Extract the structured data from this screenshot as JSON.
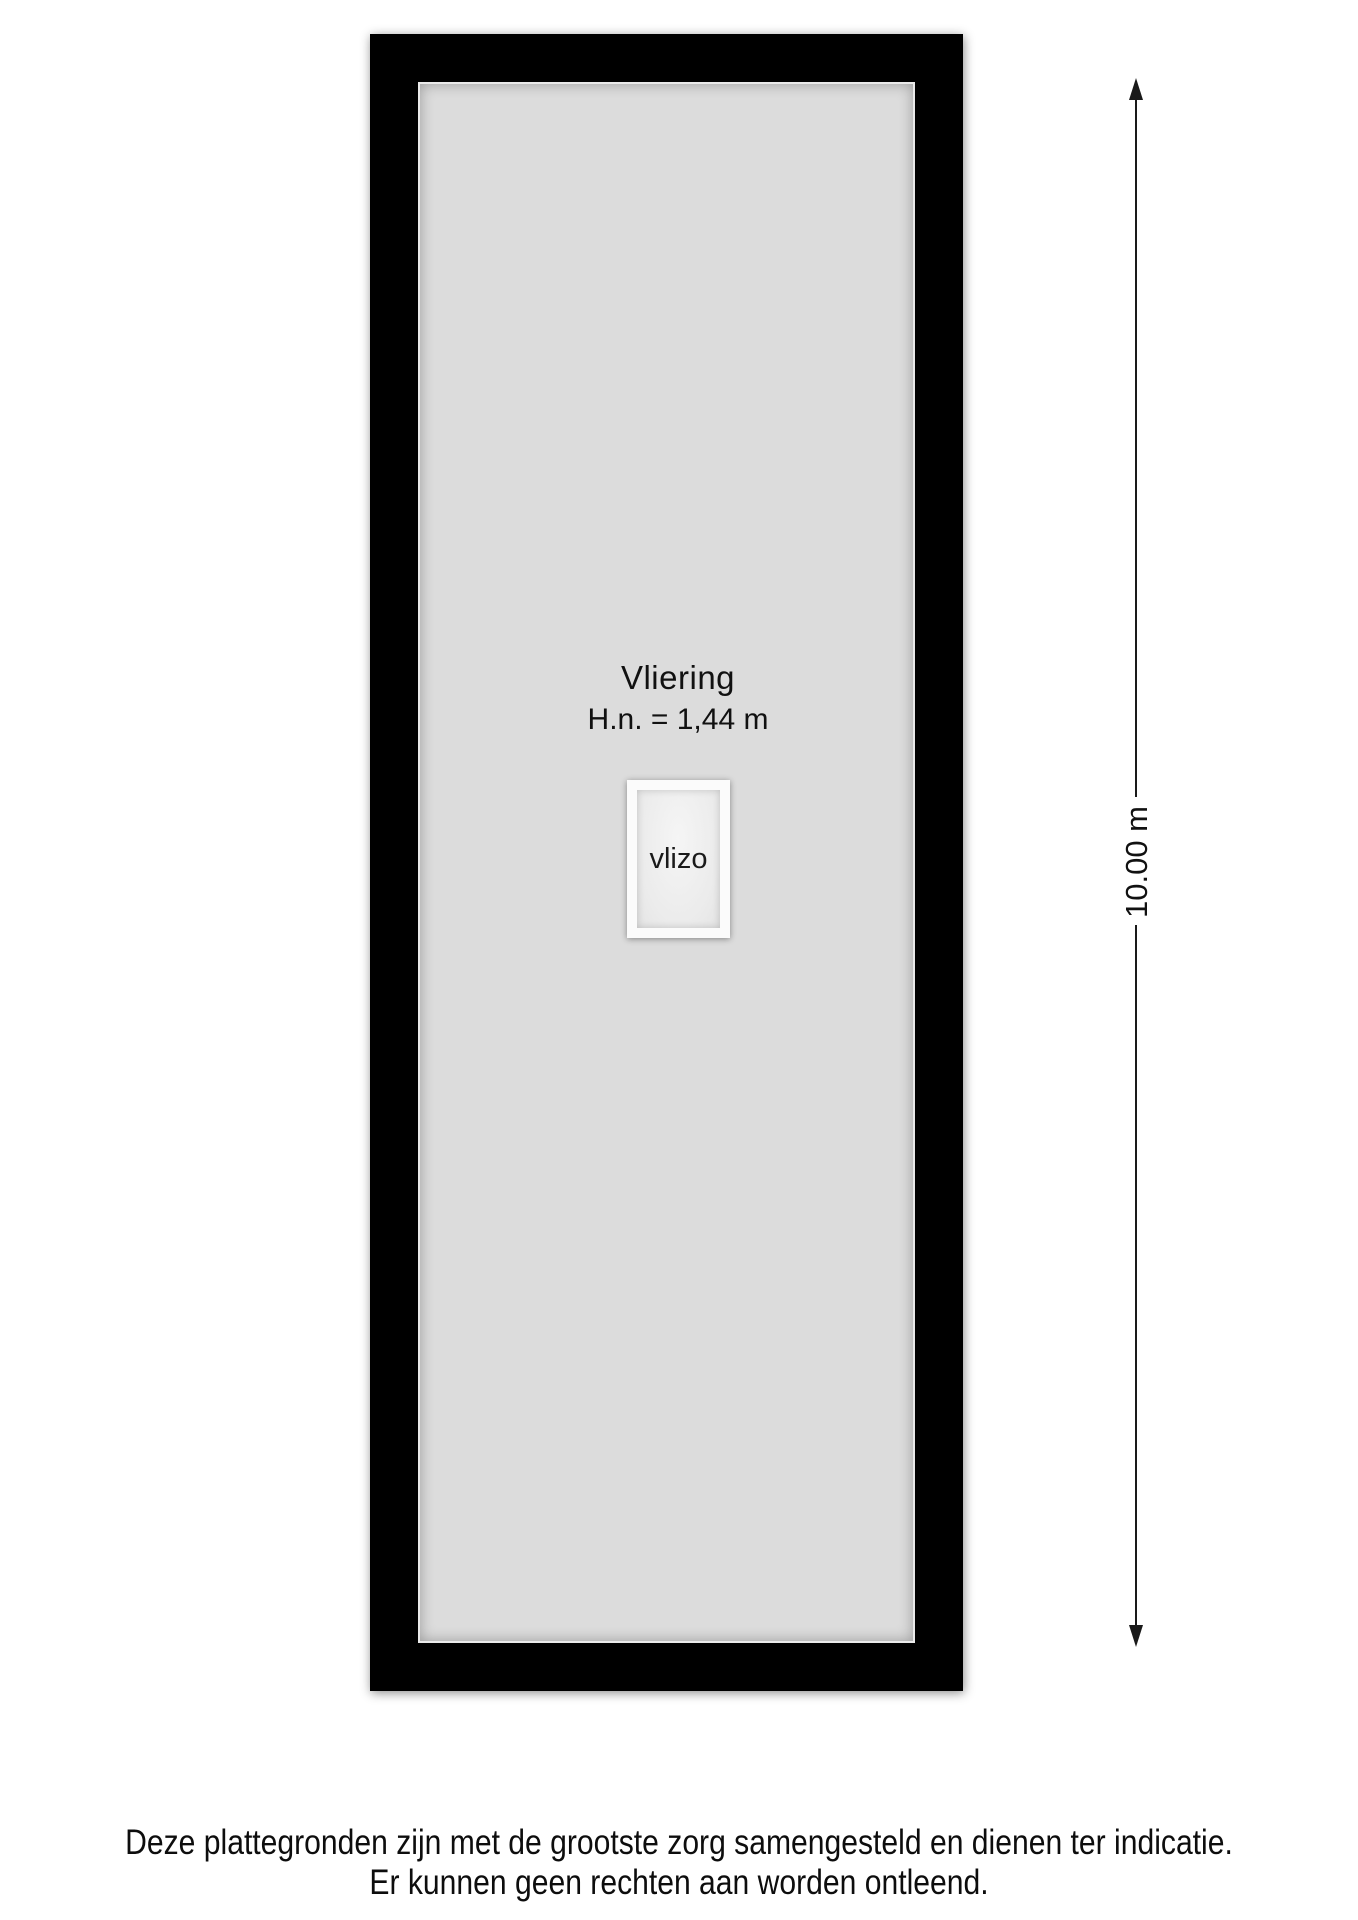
{
  "plan": {
    "room_label": "Vliering",
    "height_note": "H.n. = 1,44 m",
    "hatch_label": "vlizo",
    "dimension_label": "10.00 m"
  },
  "disclaimer": {
    "line1": "Deze plattegronden zijn met de grootste zorg samengesteld en dienen ter indicatie.",
    "line2": "Er kunnen geen rechten aan worden ontleend."
  },
  "colors": {
    "wall": "#000000",
    "floor": "#dcdcdc",
    "hatch_frame": "#fbfbfb",
    "hatch_fill": "#ebebeb",
    "background": "#ffffff",
    "text": "#111111"
  }
}
